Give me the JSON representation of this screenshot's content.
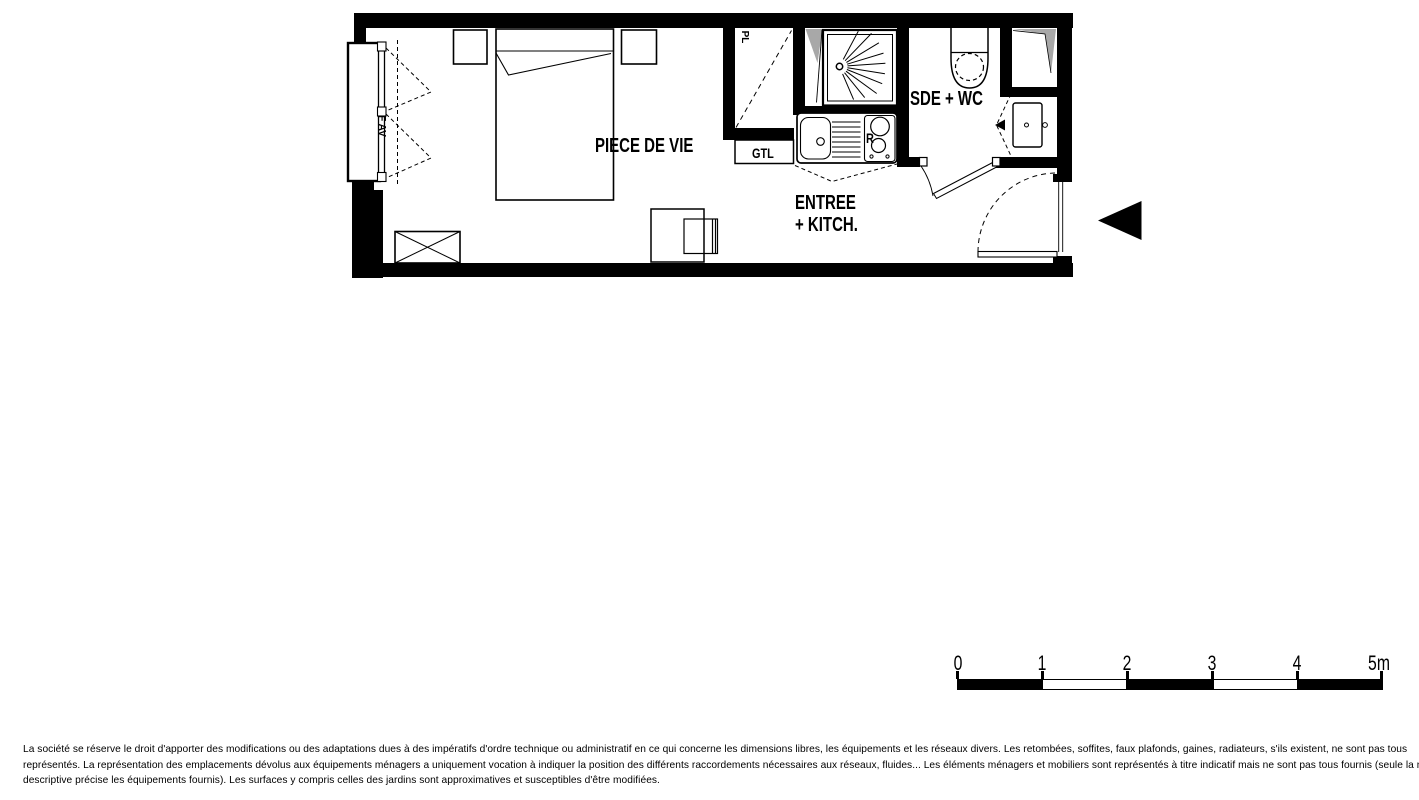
{
  "floor_plan": {
    "labels": {
      "living": "PIECE DE VIE",
      "entry_line1": "ENTREE",
      "entry_line2": "+ KITCH.",
      "bathroom": "SDE + WC",
      "gtl": "GTL",
      "closet": "PL",
      "window": "F AV",
      "fridge": "R"
    },
    "colors": {
      "wall": "#000000",
      "duct_shading": "#a8a8a8"
    }
  },
  "scale_bar": {
    "unit_labels": [
      "0",
      "1",
      "2",
      "3",
      "4",
      "5m"
    ]
  },
  "disclaimer": {
    "lines": [
      "La société se réserve le droit d'apporter des modifications ou des adaptations dues à des impératifs d'ordre technique ou administratif en ce qui concerne les dimensions libres, les équipements et les réseaux divers. Les retombées, soffites, faux plafonds, gaines, radiateurs, s'ils existent, ne sont pas tous",
      "représentés. La représentation des emplacements dévolus aux équipements ménagers a uniquement vocation à indiquer la position des différents raccordements nécessaires aux réseaux, fluides... Les éléments ménagers et mobiliers sont représentés à titre indicatif mais ne sont pas tous fournis (seule la notice",
      "descriptive précise les équipements fournis). Les surfaces y compris celles des jardins sont approximatives et susceptibles d'être modifiées."
    ]
  }
}
